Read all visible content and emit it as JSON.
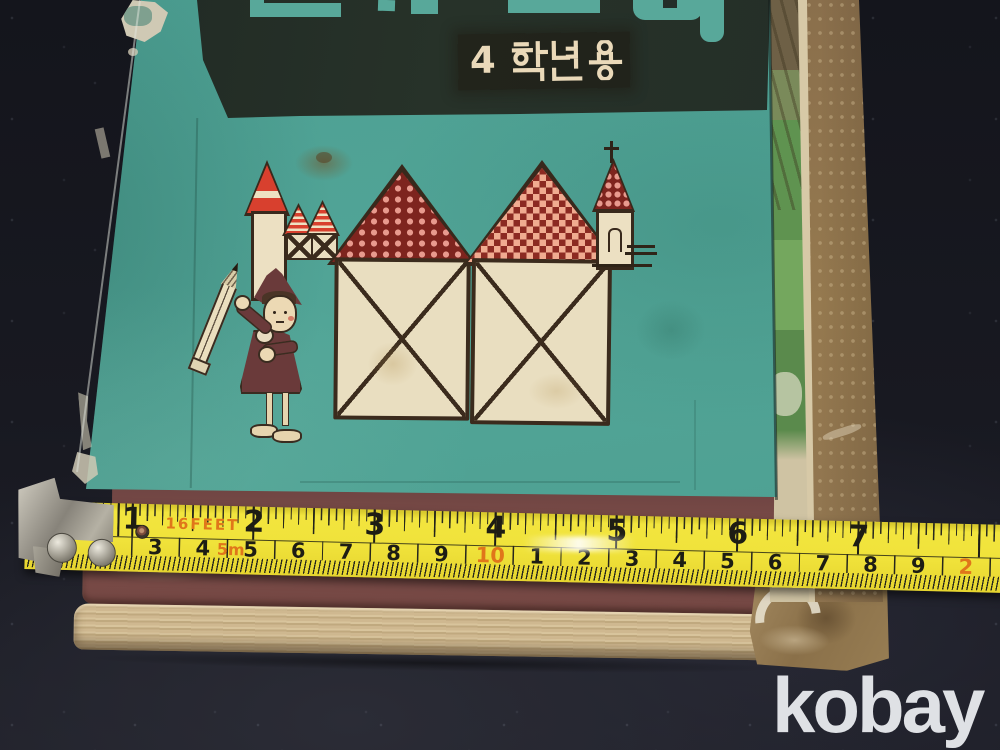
{
  "book_cover": {
    "grade_number": "4",
    "grade_suffix": "학년용",
    "grade_label_full": "4 학년용",
    "cover_color": "#4fa295",
    "header_color": "#232e29"
  },
  "tape_measure": {
    "feet_label": "16FEET",
    "meter_label": "5m",
    "inch_numbers": [
      "1",
      "2",
      "3",
      "4",
      "5",
      "6",
      "7"
    ],
    "cm_numbers": [
      "3",
      "4",
      "5",
      "6",
      "7",
      "8",
      "9",
      "10",
      "1",
      "2",
      "3",
      "4",
      "5",
      "6",
      "7",
      "8",
      "9",
      "2"
    ],
    "cm_orange_indices": [
      7,
      17
    ],
    "tape_color": "#f0e43c",
    "accent_color": "#e0761a"
  },
  "watermark": {
    "text": "kobay",
    "color": "#e9eaec"
  }
}
